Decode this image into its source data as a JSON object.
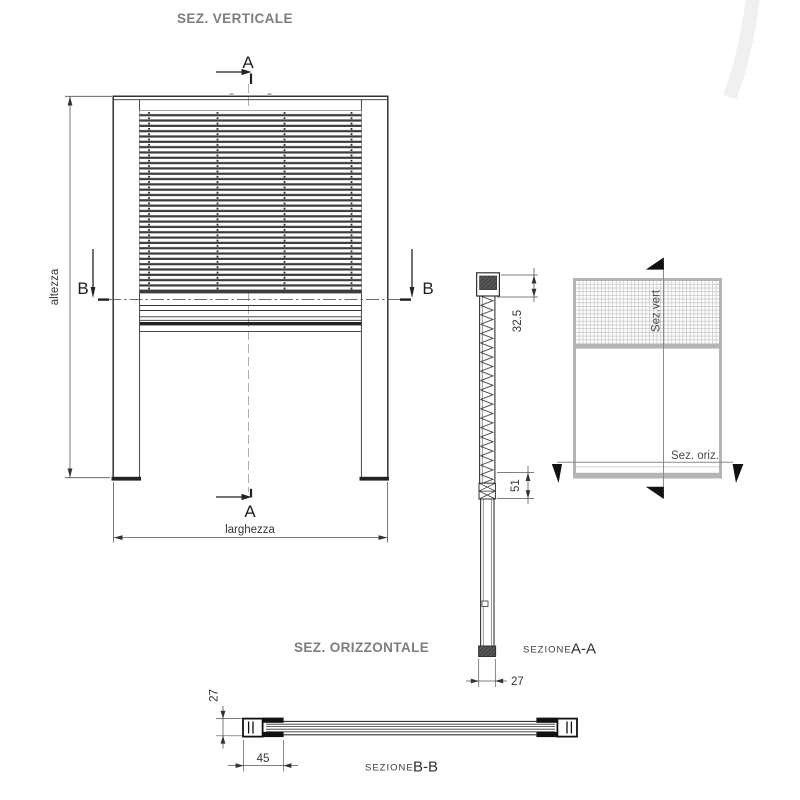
{
  "front": {
    "title": "SEZ. VERTICALE",
    "letter_a": "A",
    "letter_b": "B",
    "height_label": "altezza",
    "width_label": "larghezza"
  },
  "section_aa": {
    "caption_prefix": "SEZIONE",
    "caption": "A-A",
    "dim_headbox_height": "32.5",
    "dim_roller_height": "51",
    "dim_profile_depth": "27"
  },
  "section_bb": {
    "title": "SEZ. ORIZZONTALE",
    "caption_prefix": "SEZIONE",
    "caption": "B-B",
    "dim_profile_height": "27",
    "dim_end_zone": "45"
  },
  "minimap": {
    "vertical_cut_label": "Sez.vert",
    "horizontal_cut_label": "Sez. oriz."
  },
  "colors": {
    "line": "#333333",
    "title_gray": "#7d7d7d",
    "minimap_gray": "#b4b4b4",
    "watermark": "#f0f0f0"
  }
}
